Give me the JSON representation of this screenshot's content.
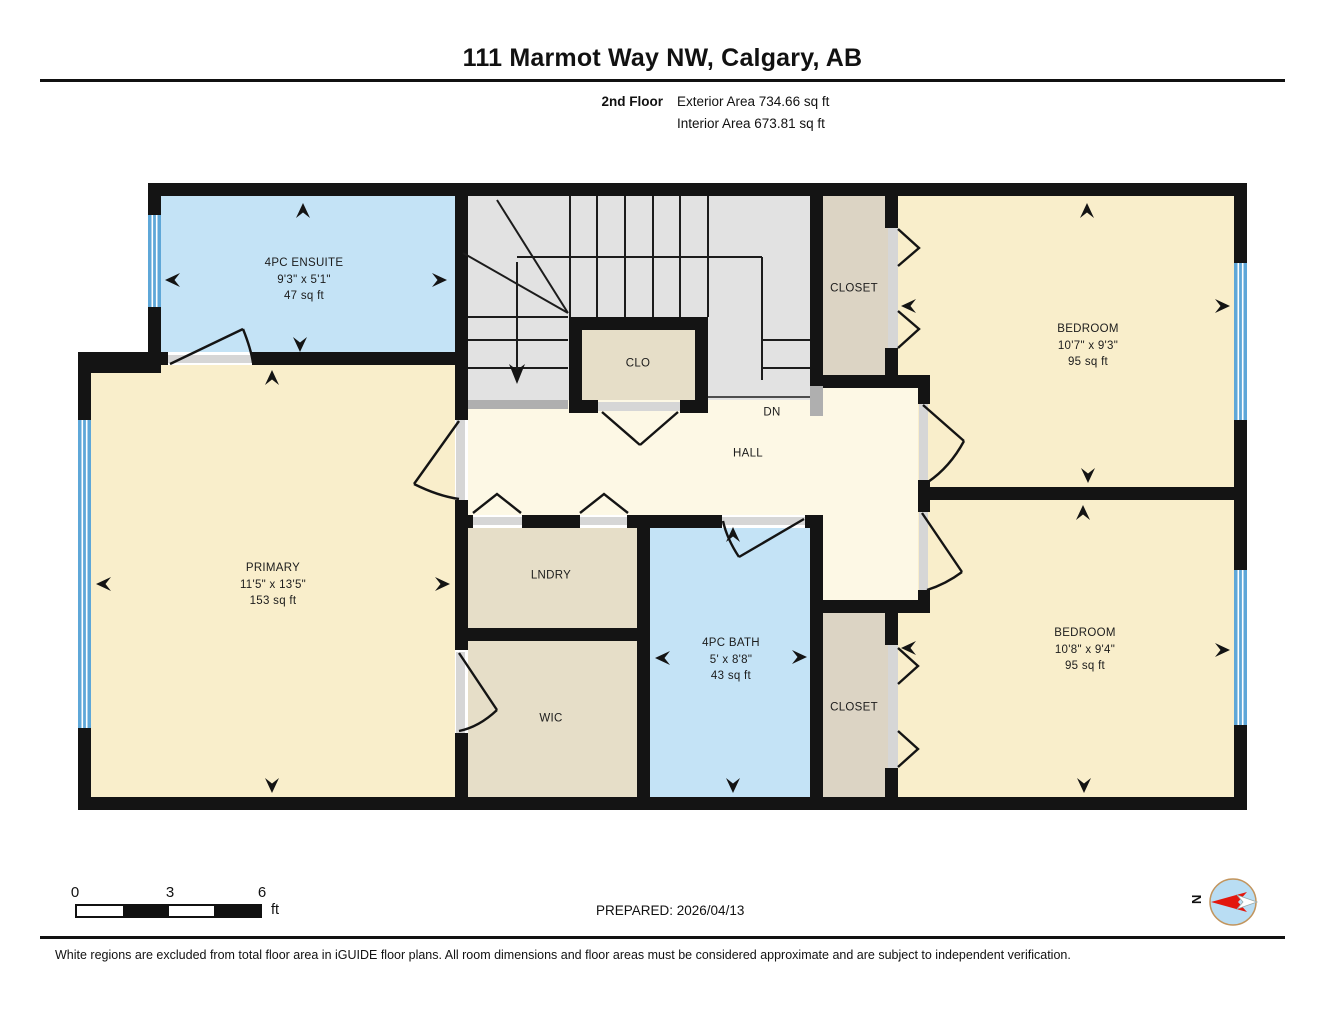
{
  "header": {
    "title": "111 Marmot Way NW, Calgary, AB",
    "floor_label": "2nd Floor",
    "exterior_area": "Exterior Area 734.66 sq ft",
    "interior_area": "Interior Area 673.81 sq ft"
  },
  "rooms": {
    "ensuite": {
      "name": "4PC ENSUITE",
      "dims": "9'3\" x 5'1\"",
      "area": "47 sq ft"
    },
    "clo": {
      "name": "CLO"
    },
    "closet_top": {
      "name": "CLOSET"
    },
    "bedroom_top": {
      "name": "BEDROOM",
      "dims": "10'7\" x 9'3\"",
      "area": "95 sq ft"
    },
    "primary": {
      "name": "PRIMARY",
      "dims": "11'5\" x 13'5\"",
      "area": "153 sq ft"
    },
    "hall": {
      "name": "HALL"
    },
    "stairs": {
      "name": "DN"
    },
    "lndry": {
      "name": "LNDRY"
    },
    "bath": {
      "name": "4PC BATH",
      "dims": "5' x 8'8\"",
      "area": "43 sq ft"
    },
    "wic": {
      "name": "WIC"
    },
    "closet_bottom": {
      "name": "CLOSET"
    },
    "bedroom_bottom": {
      "name": "BEDROOM",
      "dims": "10'8\" x 9'4\"",
      "area": "95 sq ft"
    }
  },
  "scale_bar": {
    "tick_0": "0",
    "tick_3": "3",
    "tick_6": "6",
    "unit": "ft"
  },
  "prepared_label": "PREPARED: 2026/04/13",
  "compass": {
    "north_label": "N"
  },
  "disclaimer": "White regions are excluded from total floor area in iGUIDE floor plans. All room dimensions and floor areas must be considered approximate and are subject to independent verification.",
  "colors": {
    "wall": "#141414",
    "room_cream": "#F9EECB",
    "hall_cream": "#FDF8E5",
    "wet_room_blue": "#C4E3F6",
    "closet_tan": "#DCD4C4",
    "utility_tan": "#E6DEC8",
    "stairs_gray": "#E2E2E2",
    "window_blue": "#5EA7D8",
    "compass_red": "#E3170D"
  }
}
